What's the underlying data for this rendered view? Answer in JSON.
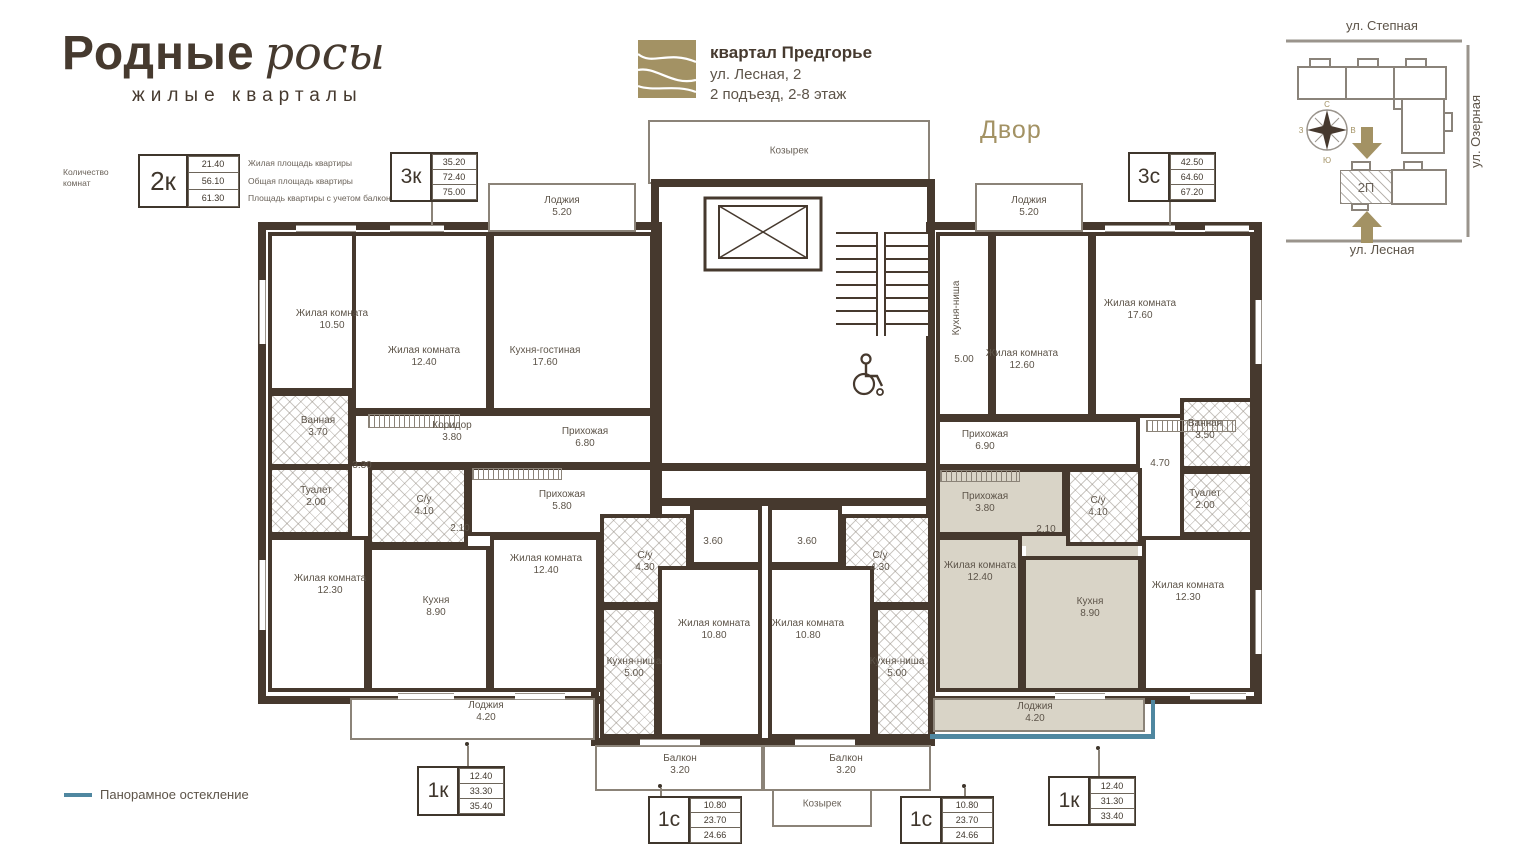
{
  "colors": {
    "wall": "#46392e",
    "accent": "#a39264",
    "highlight": "#d9d4c7",
    "glazing_line": "#4f87a0"
  },
  "brand": {
    "title_main": "Родные",
    "title_script": "росы",
    "subtitle": "жилые кварталы"
  },
  "header": {
    "complex": "квартал Предгорье",
    "address": "ул. Лесная, 2",
    "entrance": "2 подъезд, 2-8 этаж",
    "yard": "Двор"
  },
  "legend": {
    "rooms_count": "Количество комнат",
    "code": "2к",
    "rows": [
      {
        "value": "21.40",
        "label": "Жилая площадь квартиры"
      },
      {
        "value": "56.10",
        "label": "Общая площадь квартиры"
      },
      {
        "value": "61.30",
        "label": "Площадь квартиры с учетом балкона"
      }
    ]
  },
  "glazing": {
    "label": "Панорамное остекление"
  },
  "map": {
    "street_top": "ул. Степная",
    "street_right": "ул. Озерная",
    "street_bottom": "ул. Лесная",
    "block": "2П",
    "compass": {
      "n": "С",
      "e": "В",
      "s": "Ю",
      "w": "З"
    }
  },
  "canopy": "Козырек",
  "tags": {
    "t3k": {
      "code": "3к",
      "values": [
        "35.20",
        "72.40",
        "75.00"
      ]
    },
    "t3s": {
      "code": "3с",
      "values": [
        "42.50",
        "64.60",
        "67.20"
      ]
    },
    "t1k_left": {
      "code": "1к",
      "values": [
        "12.40",
        "33.30",
        "35.40"
      ]
    },
    "t1s_left": {
      "code": "1с",
      "values": [
        "10.80",
        "23.70",
        "24.66"
      ]
    },
    "t1s_right": {
      "code": "1с",
      "values": [
        "10.80",
        "23.70",
        "24.66"
      ]
    },
    "t1k_right": {
      "code": "1к",
      "values": [
        "12.40",
        "31.30",
        "33.40"
      ]
    }
  },
  "rooms": {
    "loggia_tl": {
      "name": "Лоджия",
      "area": "5.20"
    },
    "loggia_tr": {
      "name": "Лоджия",
      "area": "5.20"
    },
    "liv_1050": {
      "name": "Жилая комната",
      "area": "10.50"
    },
    "liv_1240_3k": {
      "name": "Жилая комната",
      "area": "12.40"
    },
    "kitchen_living": {
      "name": "Кухня-гостиная",
      "area": "17.60"
    },
    "bath_l": {
      "name": "Ванная",
      "area": "3.70"
    },
    "wc_l": {
      "name": "Туалет",
      "area": "2.00"
    },
    "corridor": {
      "name": "Коридор",
      "area": "3.80"
    },
    "hall_680": {
      "name": "Прихожая",
      "area": "6.80"
    },
    "hall_580": {
      "name": "Прихожая",
      "area": "5.80"
    },
    "su_l": {
      "name": "С/у",
      "area": "4.10"
    },
    "liv_1230_l": {
      "name": "Жилая комната",
      "area": "12.30"
    },
    "kitchen_l": {
      "name": "Кухня",
      "area": "8.90"
    },
    "liv_1240_1kl": {
      "name": "Жилая комната",
      "area": "12.40"
    },
    "loggia_bl": {
      "name": "Лоджия",
      "area": "4.20"
    },
    "su_430_l": {
      "name": "С/у",
      "area": "4.30"
    },
    "liv_1080_l": {
      "name": "Жилая комната",
      "area": "10.80"
    },
    "niche_l": {
      "name": "Кухня-ниша",
      "area": "5.00"
    },
    "balcony_l": {
      "name": "Балкон",
      "area": "3.20"
    },
    "su_430_r": {
      "name": "С/у",
      "area": "4.30"
    },
    "liv_1080_r": {
      "name": "Жилая комната",
      "area": "10.80"
    },
    "niche_r": {
      "name": "Кухня-ниша",
      "area": "5.00"
    },
    "balcony_r": {
      "name": "Балкон",
      "area": "3.20"
    },
    "niche_3s": {
      "name": "Кухня-ниша",
      "area": "5.00"
    },
    "liv_1260": {
      "name": "Жилая комната",
      "area": "12.60"
    },
    "liv_1760": {
      "name": "Жилая комната",
      "area": "17.60"
    },
    "hall_690": {
      "name": "Прихожая",
      "area": "6.90"
    },
    "bath_r": {
      "name": "Ванная",
      "area": "3.50"
    },
    "wc_r": {
      "name": "Туалет",
      "area": "2.00"
    },
    "hall_380": {
      "name": "Прихожая",
      "area": "3.80"
    },
    "su_r": {
      "name": "С/у",
      "area": "4.10"
    },
    "liv_1240_1kr": {
      "name": "Жилая комната",
      "area": "12.40"
    },
    "kitchen_r": {
      "name": "Кухня",
      "area": "8.90"
    },
    "liv_1230_r": {
      "name": "Жилая комната",
      "area": "12.30"
    },
    "loggia_br": {
      "name": "Лоджия",
      "area": "4.20"
    }
  },
  "dims": {
    "d330": "3.30",
    "d210_l": "2.10",
    "d360_l": "3.60",
    "d360_r": "3.60",
    "d470": "4.70",
    "d210_r": "2.10"
  }
}
